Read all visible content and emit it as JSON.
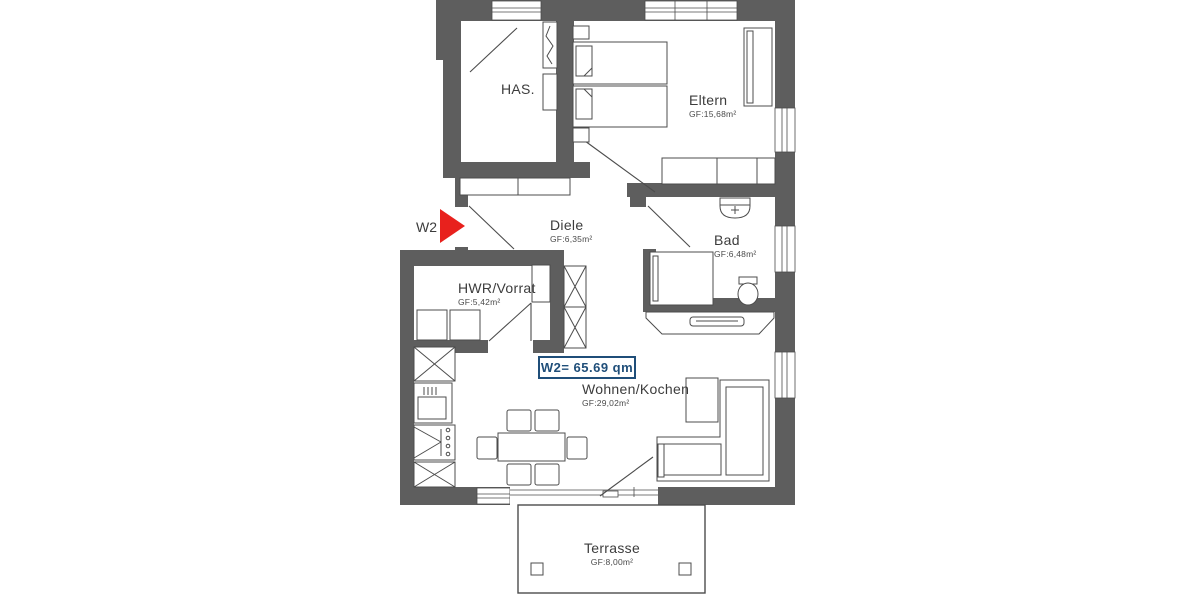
{
  "title": {
    "label": "W2= 65.69 qm"
  },
  "entrance": {
    "label": "W2"
  },
  "rooms": {
    "has": {
      "name": "HAS.",
      "area": ""
    },
    "eltern": {
      "name": "Eltern",
      "area": "GF:15,68m²"
    },
    "diele": {
      "name": "Diele",
      "area": "GF:6,35m²"
    },
    "bad": {
      "name": "Bad",
      "area": "GF:6,48m²"
    },
    "hwr": {
      "name": "HWR/Vorrat",
      "area": "GF:5,42m²"
    },
    "wohnen": {
      "name": "Wohnen/Kochen",
      "area": "GF:29,02m²"
    },
    "terrasse": {
      "name": "Terrasse",
      "area": "GF:8,00m²"
    }
  },
  "colors": {
    "wall": "#5e5e5e",
    "line": "#4c4c4c",
    "accent_blue": "#1f4e79",
    "arrow_red": "#e8211d"
  }
}
